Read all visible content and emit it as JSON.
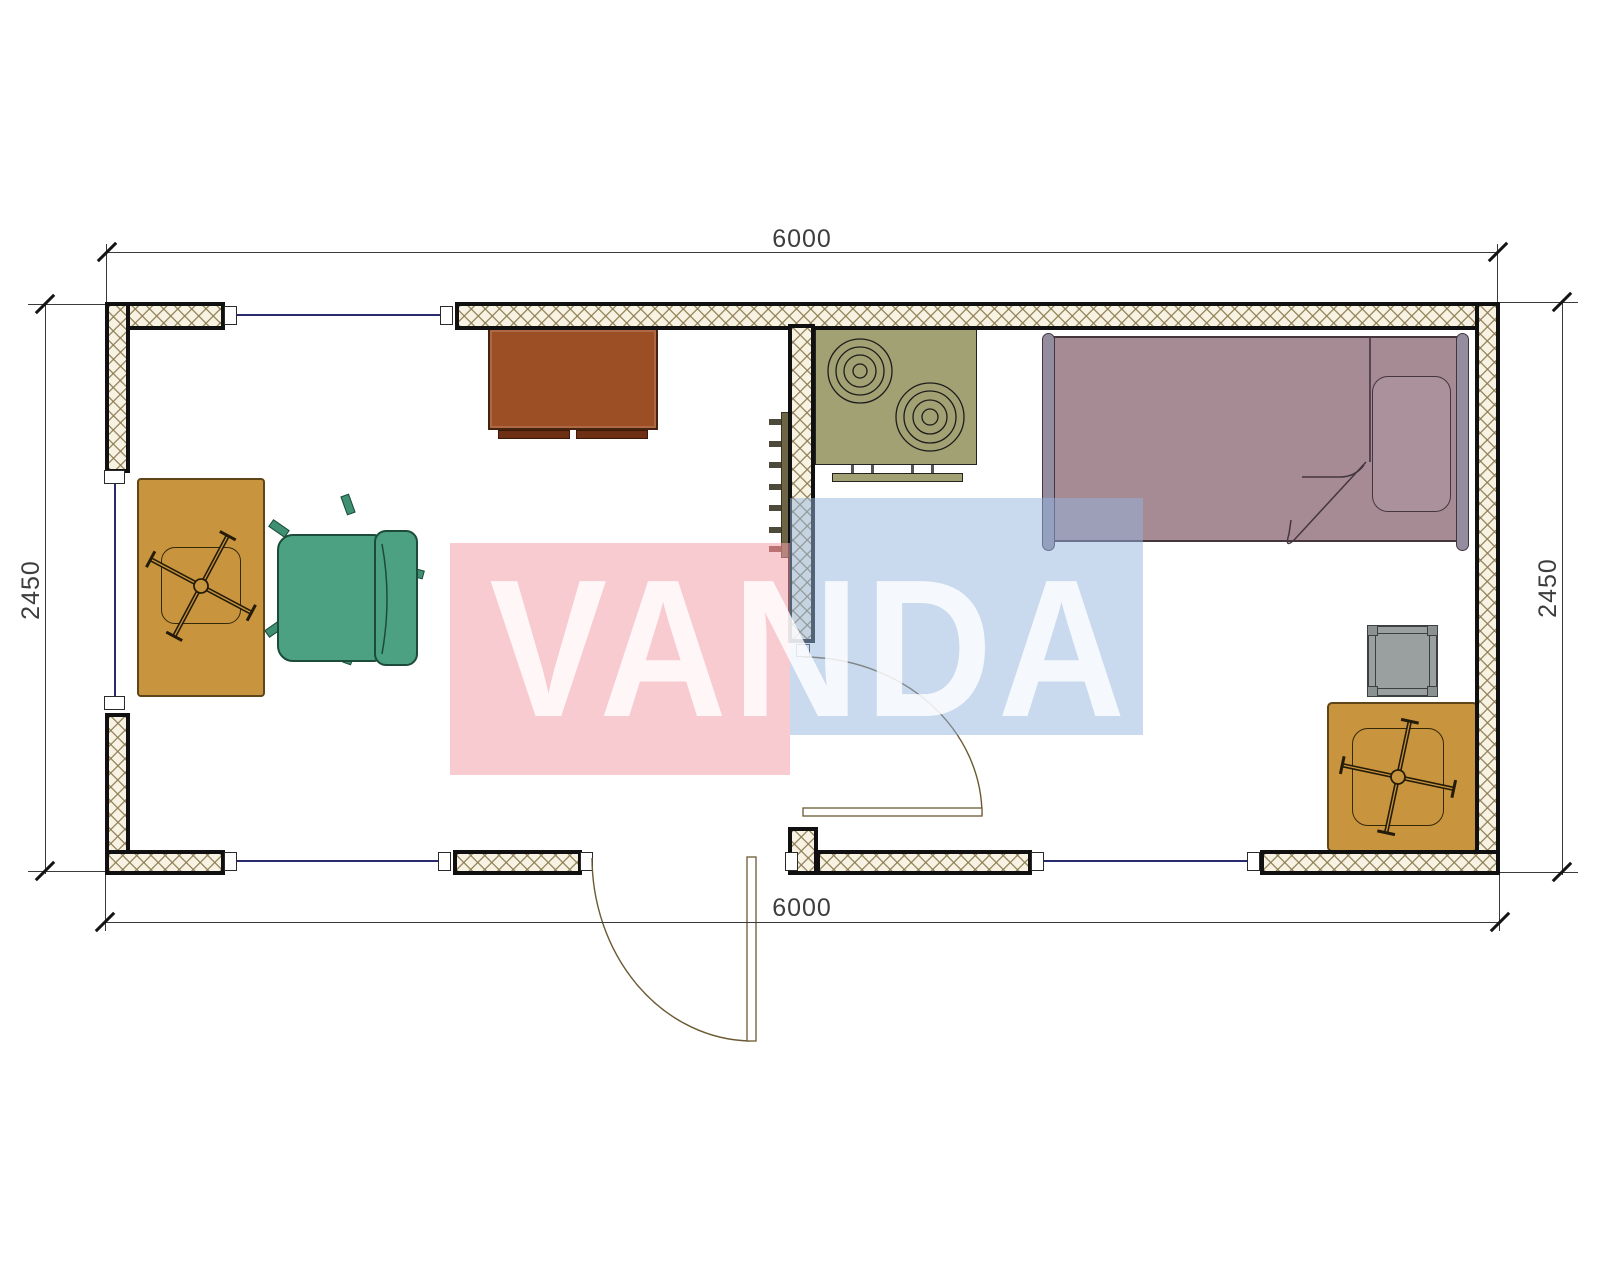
{
  "drawing": {
    "type": "floor-plan",
    "watermark": {
      "text": "VANDA",
      "pink": "#f2a0ac",
      "blue": "#94b4de"
    },
    "dimensions": {
      "top_width_mm": "6000",
      "bottom_width_mm": "6000",
      "left_height_mm": "2450",
      "right_height_mm": "2450"
    },
    "colors": {
      "wall_hatch_bg": "#f8f2e2",
      "wall_hatch_line": "#8b7c52",
      "wall_border": "#101010",
      "glazing_line": "#2a2a6e",
      "dimension_line": "#3a3a3a",
      "dimension_text": "#3d3d3d",
      "tv_cabinet": "#9c4e25",
      "cooktop": "#a2a173",
      "radiator": "#6e6546",
      "bed": "#a68b95",
      "bed_frame": "#948da0",
      "stool": "#9aa0a0",
      "desk_wood": "#c9943e",
      "office_chair": "#4ba181",
      "door_line": "#6b5a33"
    },
    "rooms": [
      {
        "id": "living-room",
        "side": "left"
      },
      {
        "id": "bedroom-kitchen",
        "side": "right"
      }
    ],
    "furniture": [
      {
        "id": "tv-cabinet",
        "color": "#9c4e25"
      },
      {
        "id": "cooktop-stove",
        "color": "#a2a173",
        "burners": 2
      },
      {
        "id": "kitchen-shelf",
        "color": "#a2a173"
      },
      {
        "id": "wall-radiator",
        "color": "#6e6546",
        "fins": 7
      },
      {
        "id": "single-bed",
        "color": "#a68b95"
      },
      {
        "id": "pillow",
        "color": "#ab919b"
      },
      {
        "id": "bedside-stool",
        "color": "#9aa0a0"
      },
      {
        "id": "desk-with-swivel-chair-left",
        "color": "#c9943e"
      },
      {
        "id": "office-chair",
        "color": "#4ba181"
      },
      {
        "id": "desk-with-swivel-chair-right",
        "color": "#c9943e"
      }
    ],
    "openings": {
      "windows": 4,
      "exterior_doors": 1,
      "interior_doors": 1
    }
  }
}
